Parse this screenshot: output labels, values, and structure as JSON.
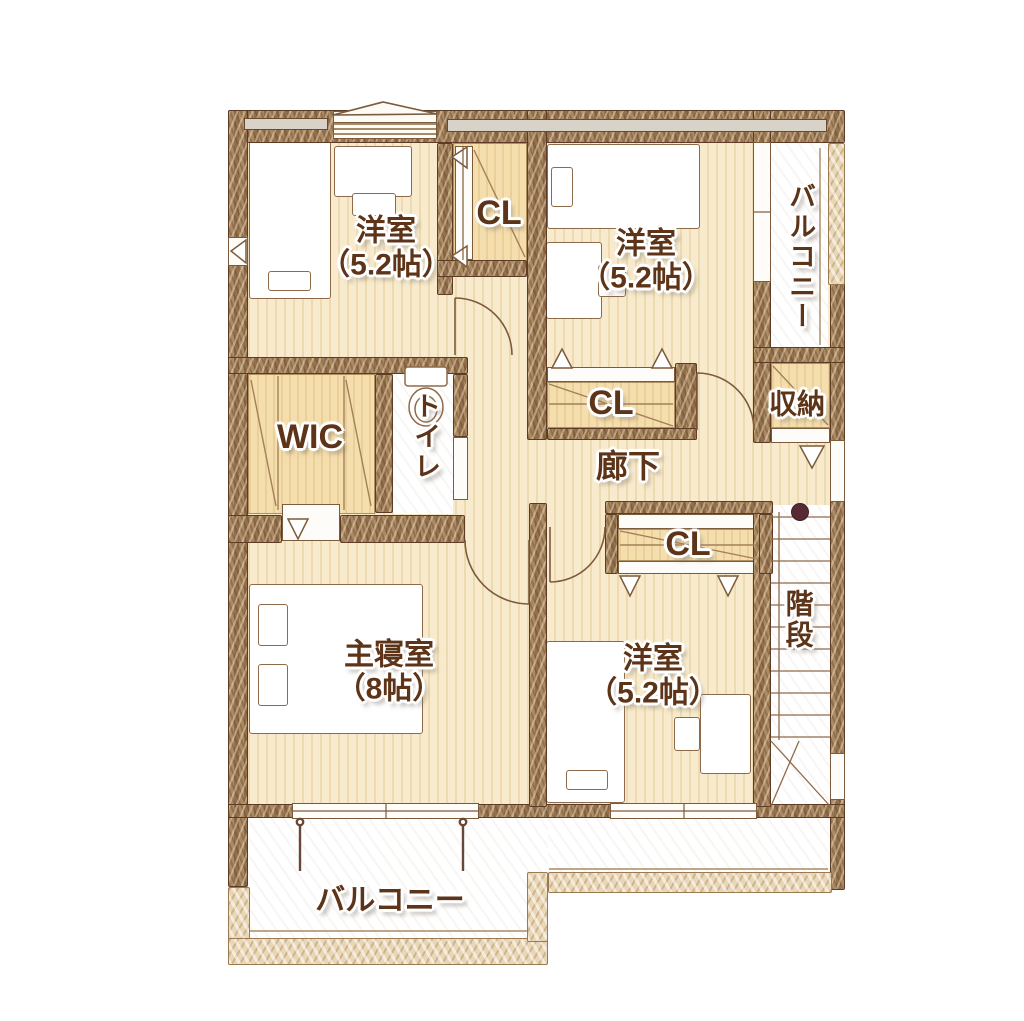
{
  "rooms": {
    "bedroom_top_left": {
      "name": "洋室",
      "size": "（5.2帖）"
    },
    "bedroom_top_right": {
      "name": "洋室",
      "size": "（5.2帖）"
    },
    "master_bedroom": {
      "name": "主寝室",
      "size": "（8帖）"
    },
    "bedroom_bottom_right": {
      "name": "洋室",
      "size": "（5.2帖）"
    },
    "closet_top": {
      "label": "CL"
    },
    "closet_middle": {
      "label": "CL"
    },
    "closet_bottom": {
      "label": "CL"
    },
    "walk_in_closet": {
      "label": "WIC"
    },
    "toilet": {
      "label": "トイレ"
    },
    "hallway": {
      "label": "廊下"
    },
    "storage": {
      "label": "収納"
    },
    "stairs": {
      "label": "階段"
    },
    "balcony_side": {
      "label": "バルコニー"
    },
    "balcony_bottom": {
      "label": "バルコニー"
    }
  },
  "colors": {
    "wall": "#a3805a",
    "wall_outline": "#5e3b24",
    "floor_cream": "#f8ebcd",
    "closet_tan": "#f4deae",
    "balcony_wall": "#e9d6b4",
    "label_text": "#5d3418",
    "stair_post": "#572b36"
  }
}
